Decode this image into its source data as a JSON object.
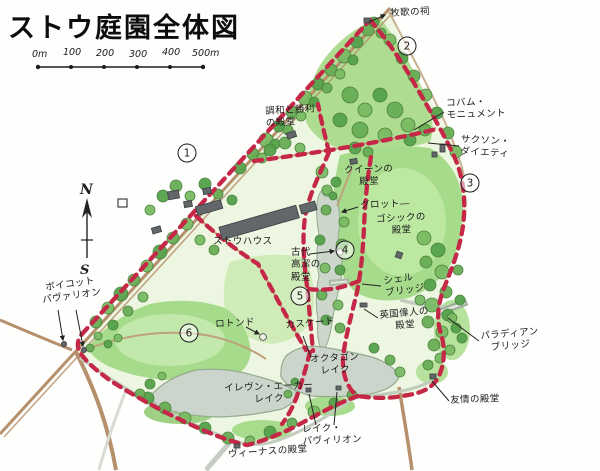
{
  "title": "ストウ庭園全体図",
  "scale_bar": {
    "labels": [
      "0m",
      "100",
      "200",
      "300",
      "400",
      "500m"
    ]
  },
  "compass": {
    "north": "N",
    "south": "S"
  },
  "stations": [
    {
      "n": "1",
      "x": 187,
      "y": 153
    },
    {
      "n": "2",
      "x": 407,
      "y": 46
    },
    {
      "n": "3",
      "x": 470,
      "y": 183
    },
    {
      "n": "4",
      "x": 345,
      "y": 250
    },
    {
      "n": "5",
      "x": 300,
      "y": 296
    },
    {
      "n": "6",
      "x": 189,
      "y": 333
    }
  ],
  "labels": [
    {
      "id": "pastoral-shrine",
      "text": "牧歌の祠",
      "x": 390,
      "y": 8,
      "rot": -3,
      "align": "left"
    },
    {
      "id": "cobham-monument",
      "text": "コバム・\nモニュメント",
      "x": 446,
      "y": 98,
      "rot": -2,
      "align": "left"
    },
    {
      "id": "saxon-deities",
      "text": "サクソン・\nダイエティ",
      "x": 461,
      "y": 134,
      "rot": 3,
      "align": "center"
    },
    {
      "id": "concord-victory-temple",
      "text": "調和と勝利\nの殿堂",
      "x": 265,
      "y": 106,
      "rot": -3,
      "align": "left"
    },
    {
      "id": "queens-temple",
      "text": "クイーンの\n殿堂",
      "x": 344,
      "y": 165,
      "rot": -2,
      "align": "center"
    },
    {
      "id": "grotto",
      "text": "グロット―",
      "x": 360,
      "y": 200,
      "rot": -2,
      "align": "left"
    },
    {
      "id": "gothic-temple",
      "text": "ゴシックの\n殿堂",
      "x": 376,
      "y": 214,
      "rot": -3,
      "align": "center"
    },
    {
      "id": "stowe-house",
      "text": "ストウハウス",
      "x": 213,
      "y": 236,
      "rot": 0,
      "align": "left"
    },
    {
      "id": "ancient-virtue-temple",
      "text": "古代\n高潔の\n殿堂",
      "x": 291,
      "y": 247,
      "rot": 0,
      "align": "left"
    },
    {
      "id": "shell-bridge",
      "text": "シェル\nブリッジ",
      "x": 383,
      "y": 276,
      "rot": -8,
      "align": "left"
    },
    {
      "id": "british-worthies-temple",
      "text": "英国偉人の\n殿堂",
      "x": 379,
      "y": 310,
      "rot": -5,
      "align": "center"
    },
    {
      "id": "palladian-bridge",
      "text": "パラディアン\nブリッジ",
      "x": 480,
      "y": 331,
      "rot": -5,
      "align": "center"
    },
    {
      "id": "friendship-temple",
      "text": "友情の殿堂",
      "x": 450,
      "y": 395,
      "rot": -2,
      "align": "left"
    },
    {
      "id": "boycott-pavilion",
      "text": "ボイコット\nパヴァリオン",
      "x": 40,
      "y": 283,
      "rot": -8,
      "align": "center"
    },
    {
      "id": "rotondo",
      "text": "ロトンド",
      "x": 215,
      "y": 319,
      "rot": -3,
      "align": "left"
    },
    {
      "id": "cascade",
      "text": "カスケード",
      "x": 285,
      "y": 320,
      "rot": -5,
      "align": "left"
    },
    {
      "id": "octagon-lake",
      "text": "オクタゴン\nレイク",
      "x": 310,
      "y": 354,
      "rot": -3,
      "align": "center"
    },
    {
      "id": "eleven-acre-lake",
      "text": "イレヴン・エーカー\nレイク",
      "x": 224,
      "y": 383,
      "rot": -2,
      "align": "center"
    },
    {
      "id": "lake-pavilion",
      "text": "レイク・\nパヴィリオン",
      "x": 302,
      "y": 424,
      "rot": -2,
      "align": "left"
    },
    {
      "id": "venus-temple",
      "text": "ヴィーナスの殿堂",
      "x": 228,
      "y": 449,
      "rot": -4,
      "align": "left"
    }
  ]
}
